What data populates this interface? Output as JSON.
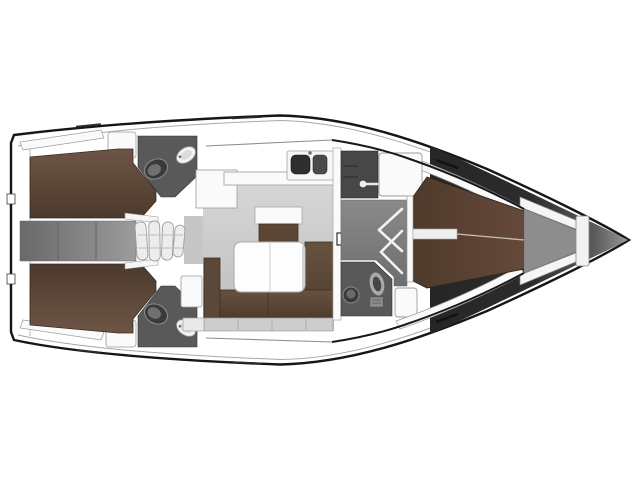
{
  "meta": {
    "title": "Sailing yacht interior layout plan (top view, bow to the right)",
    "type": "floorplan",
    "orientation": "bow-right"
  },
  "rooms": {
    "hull": "Hull",
    "aft_cabin_port": "Aft double cabin (port)",
    "aft_cabin_stbd": "Aft double cabin (starboard)",
    "aft_head_port": "Aft head / WC (port)",
    "aft_head_stbd": "Aft head / WC (starboard)",
    "companionway": "Companionway steps",
    "galley": "Galley with double sink",
    "salon": "Salon with U-sofa and folding table",
    "sideboard": "Salon sideboard",
    "wardrobe": "Wardrobe with hanging rod",
    "fwd_corridor": "Forward cabin entrance with lockers",
    "fwd_head": "Forward head with WC and washbasin",
    "fwd_cabin": "Forward double cabin (V-berth)",
    "anchor_locker": "Anchor locker"
  },
  "fixtures": {
    "toilet": "toilet-icon",
    "sink": "washbasin-icon",
    "double_sink": "galley-double-sink-icon",
    "hanging_rod": "wardrobe-rod-icon",
    "locker_chevron": "locker-door-chevron-icon",
    "steps": "companionway-steps-icon",
    "table": "salon-table-icon"
  },
  "colors": {
    "outline": "#161616",
    "hull_white": "#ffffff",
    "furniture_white": "#fafafa",
    "wall_stroke": "#9b9b9b",
    "floor_light_1": "#d6d6d6",
    "floor_light_2": "#bdbdbd",
    "landing_gray": "#c6c6c6",
    "corridor_aft_1": "#696969",
    "corridor_aft_2": "#9c9c9c",
    "corridor_fwd_1": "#8a8a8a",
    "corridor_fwd_2": "#6e6e6e",
    "head_floor": "#595959",
    "wardrobe_floor": "#474747",
    "bed_brown_1": "#6d5545",
    "bed_brown_2": "#4c3a2d",
    "fwd_bed_1": "#4f3a2c",
    "fwd_bed_2": "#65493a",
    "sofa_1": "#67523f",
    "sofa_2": "#4d3c2e",
    "sofa_arm": "#5b4839",
    "table_white": "#fdfdfd",
    "fixture_dark": "#3a3a3a",
    "basin_dark": "#2e2e2e",
    "anchor_floor": "#8d8d8d",
    "bow_dark": "#262626",
    "bow_tip": "#9b9b9b",
    "under_sofa": "#cdcdcd"
  }
}
